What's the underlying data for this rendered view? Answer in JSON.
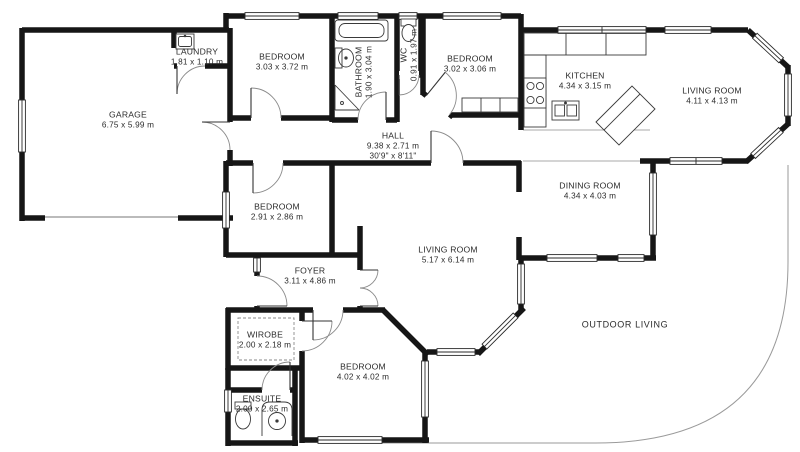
{
  "title": "Floor plan",
  "rooms": {
    "garage": {
      "name": "GARAGE",
      "dims": "6.75 x 5.99 m"
    },
    "laundry": {
      "name": "LAUNDRY",
      "dims": "1.81 x 1.10 m"
    },
    "bedroom_top": {
      "name": "BEDROOM",
      "dims": "3.03 x 3.72 m"
    },
    "bathroom": {
      "name": "BATHROOM",
      "dims": "1.90 x 3.04 m"
    },
    "wc": {
      "name": "WC",
      "dims": "0.91 x 1.97 m"
    },
    "bedroom_top_right": {
      "name": "BEDROOM",
      "dims": "3.02 x 3.06 m"
    },
    "kitchen": {
      "name": "KITCHEN",
      "dims": "4.34 x 3.15 m"
    },
    "living_room_right": {
      "name": "LIVING ROOM",
      "dims": "4.11 x 4.13 m"
    },
    "hall": {
      "name": "HALL",
      "dims": "9.38 x 2.71 m",
      "dims_imperial": "30'9\" x 8'11\""
    },
    "bedroom_mid": {
      "name": "BEDROOM",
      "dims": "2.91 x 2.86 m"
    },
    "dining_room": {
      "name": "DINING ROOM",
      "dims": "4.34 x 4.03 m"
    },
    "living_room_main": {
      "name": "LIVING ROOM",
      "dims": "5.17 x 6.14 m"
    },
    "foyer": {
      "name": "FOYER",
      "dims": "3.11 x 4.86 m"
    },
    "wardrobe": {
      "name": "WIROBE",
      "dims": "2.00 x 2.18 m"
    },
    "bedroom_bottom": {
      "name": "BEDROOM",
      "dims": "4.02 x 4.02 m"
    },
    "ensuite": {
      "name": "ENSUITE",
      "dims": "2.00 x 2.65 m"
    },
    "outdoor": {
      "name": "OUTDOOR LIVING"
    }
  },
  "colors": {
    "wall": "#161616",
    "thin_line": "#9a9a9a",
    "text": "#2b2b2b",
    "background": "#ffffff"
  }
}
